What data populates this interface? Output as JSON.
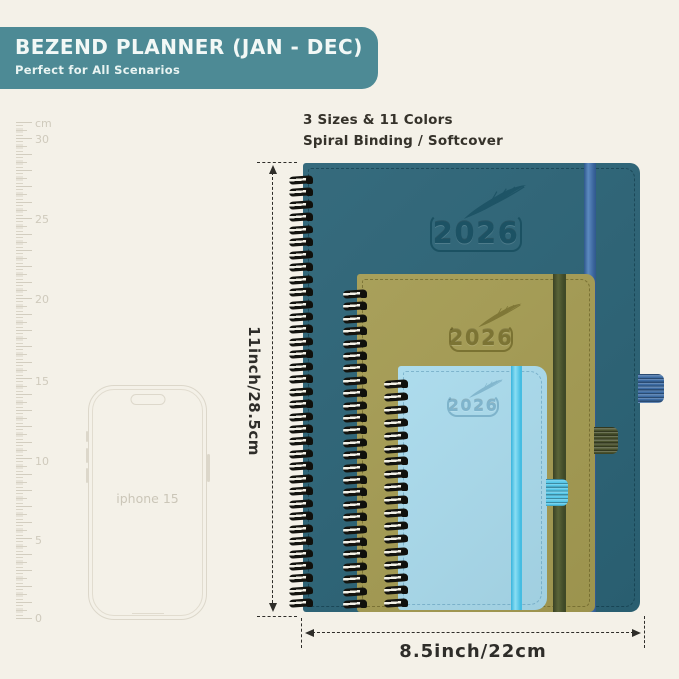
{
  "header": {
    "title": "BEZEND PLANNER (JAN - DEC)",
    "subtitle": "Perfect for All Scenarios"
  },
  "info": {
    "line1": "3 Sizes & 11 Colors",
    "line2": "Spiral Binding / Softcover"
  },
  "ruler": {
    "unit_label": "cm",
    "marks": [
      "30",
      "25",
      "20",
      "15",
      "10",
      "5",
      "0"
    ]
  },
  "phone": {
    "label": "iphone 15"
  },
  "planners": {
    "large": {
      "year": "2026",
      "cover_color": "#2b6376",
      "elastic_color": "#3d6da5"
    },
    "medium": {
      "year": "2026",
      "cover_color": "#a49b52",
      "elastic_color": "#49512d"
    },
    "small": {
      "year": "2026",
      "cover_color": "#a9daec",
      "elastic_color": "#55c7e8"
    }
  },
  "dimensions": {
    "height_label": "11inch/28.5cm",
    "width_label": "8.5inch/22cm"
  },
  "colors": {
    "background": "#f4f1e8",
    "banner": "#4d8a95",
    "annotation_text": "#2e2d29",
    "ruler_gray": "#d2cdbf"
  }
}
